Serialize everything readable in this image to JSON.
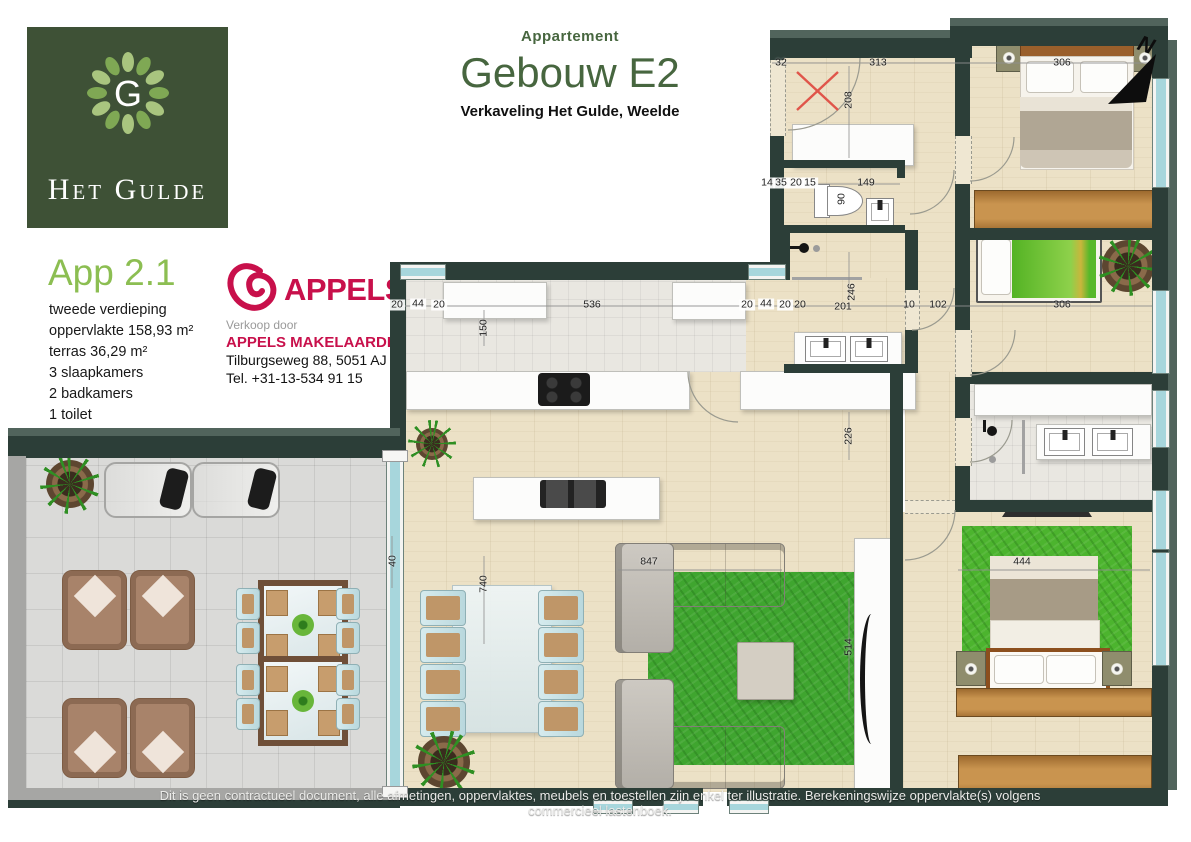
{
  "brand": {
    "logo_monogram": "G",
    "logo_name": "Het Gulde",
    "logo_bg": "#3e5136",
    "leaf_light": "#a9c57f",
    "leaf_dark": "#7fa854"
  },
  "header": {
    "kicker": "Appartement",
    "title": "Gebouw E2",
    "subtitle": "Verkaveling Het Gulde, Weelde",
    "accent_color": "#47663f"
  },
  "apartment": {
    "name": "App 2.1",
    "accent_color": "#8cbe52",
    "details": [
      "tweede verdieping",
      "oppervlakte 158,93 m²",
      "terras 36,29 m²",
      "3 slaapkamers",
      "2 badkamers",
      "1 toilet"
    ]
  },
  "broker": {
    "logo_text": "APPELS",
    "brand_color": "#c8104b",
    "sold_by": "Verkoop door",
    "name": "APPELS MAKELAARDIJ",
    "address": "Tilburgseweg 88, 5051 AJ Goirle",
    "phone": "Tel. +31-13-534 91 15"
  },
  "plan": {
    "north": "N",
    "wall_color": "#2c3e38",
    "floor_color": "#ece1c6",
    "terrace_color": "#dadad8",
    "window_color": "#a7d6dc",
    "rug_color": "#3fa52f",
    "dims": {
      "entry_door": "32",
      "entry_width": "313",
      "entry_depth": "208",
      "t1": "14",
      "t2": "35",
      "t3": "20",
      "t4": "15",
      "toilet_width": "149",
      "toilet_depth": "90",
      "bed1_width": "306",
      "wl1": "20",
      "wl2": "44",
      "wl3": "20",
      "kitchen_width": "536",
      "kitchen_depth": "150",
      "wr1": "20",
      "wr2": "44",
      "wr3": "20",
      "hall_left": "20",
      "hall_a": "201",
      "hall_b": "246",
      "hall_c": "10",
      "hall_d": "102",
      "bed2_width": "306",
      "living_a": "226",
      "dining_len": "740",
      "living_w": "847",
      "living_b": "514",
      "bed3_width": "444",
      "terrace_door": "40"
    }
  },
  "disclaimer": "Dit is geen contractueel document, alle afmetingen, oppervlaktes, meubels en toestellen zijn enkel ter illustratie. Berekeningswijze oppervlakte(s) volgens commercieel lastenboek."
}
